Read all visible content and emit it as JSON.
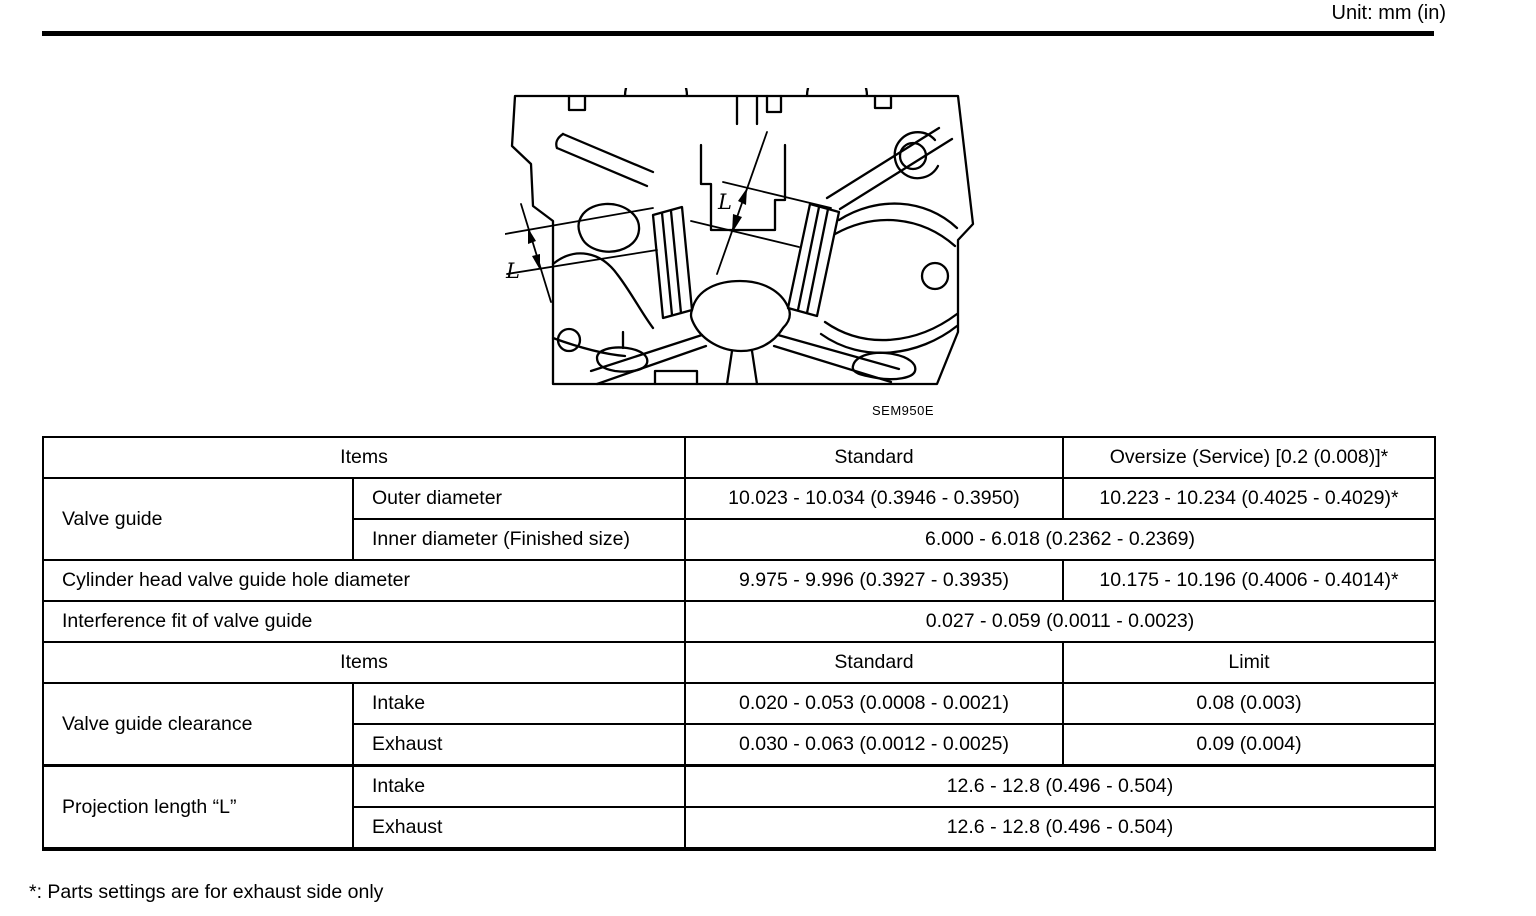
{
  "page": {
    "unit_label": "Unit: mm (in)",
    "footnote": "*: Parts settings are for exhaust side only"
  },
  "figure": {
    "caption": "SEM950E",
    "dimension_labels": {
      "left": "L",
      "center": "L"
    }
  },
  "spec_table": {
    "header_top": {
      "items": "Items",
      "standard": "Standard",
      "oversize": "Oversize (Service) [0.2 (0.008)]*"
    },
    "valve_guide": {
      "label": "Valve guide",
      "outer_diameter": {
        "label": "Outer diameter",
        "standard": "10.023 - 10.034 (0.3946 - 0.3950)",
        "oversize": "10.223 - 10.234 (0.4025 - 0.4029)*"
      },
      "inner_diameter": {
        "label": "Inner diameter (Finished size)",
        "value": "6.000 - 6.018 (0.2362 - 0.2369)"
      }
    },
    "hole_diameter": {
      "label": "Cylinder head valve guide hole diameter",
      "standard": "9.975 - 9.996 (0.3927 - 0.3935)",
      "oversize": "10.175 - 10.196 (0.4006 - 0.4014)*"
    },
    "interference_fit": {
      "label": "Interference fit of valve guide",
      "value": "0.027 - 0.059 (0.0011 - 0.0023)"
    },
    "header_bottom": {
      "items": "Items",
      "standard": "Standard",
      "limit": "Limit"
    },
    "clearance": {
      "label": "Valve guide clearance",
      "intake": {
        "label": "Intake",
        "standard": "0.020 - 0.053 (0.0008 - 0.0021)",
        "limit": "0.08 (0.003)"
      },
      "exhaust": {
        "label": "Exhaust",
        "standard": "0.030 - 0.063 (0.0012 - 0.0025)",
        "limit": "0.09 (0.004)"
      }
    },
    "projection_length": {
      "label": "Projection length “L”",
      "intake": {
        "label": "Intake",
        "value": "12.6 - 12.8 (0.496 - 0.504)"
      },
      "exhaust": {
        "label": "Exhaust",
        "value": "12.6 - 12.8 (0.496 - 0.504)"
      }
    }
  }
}
